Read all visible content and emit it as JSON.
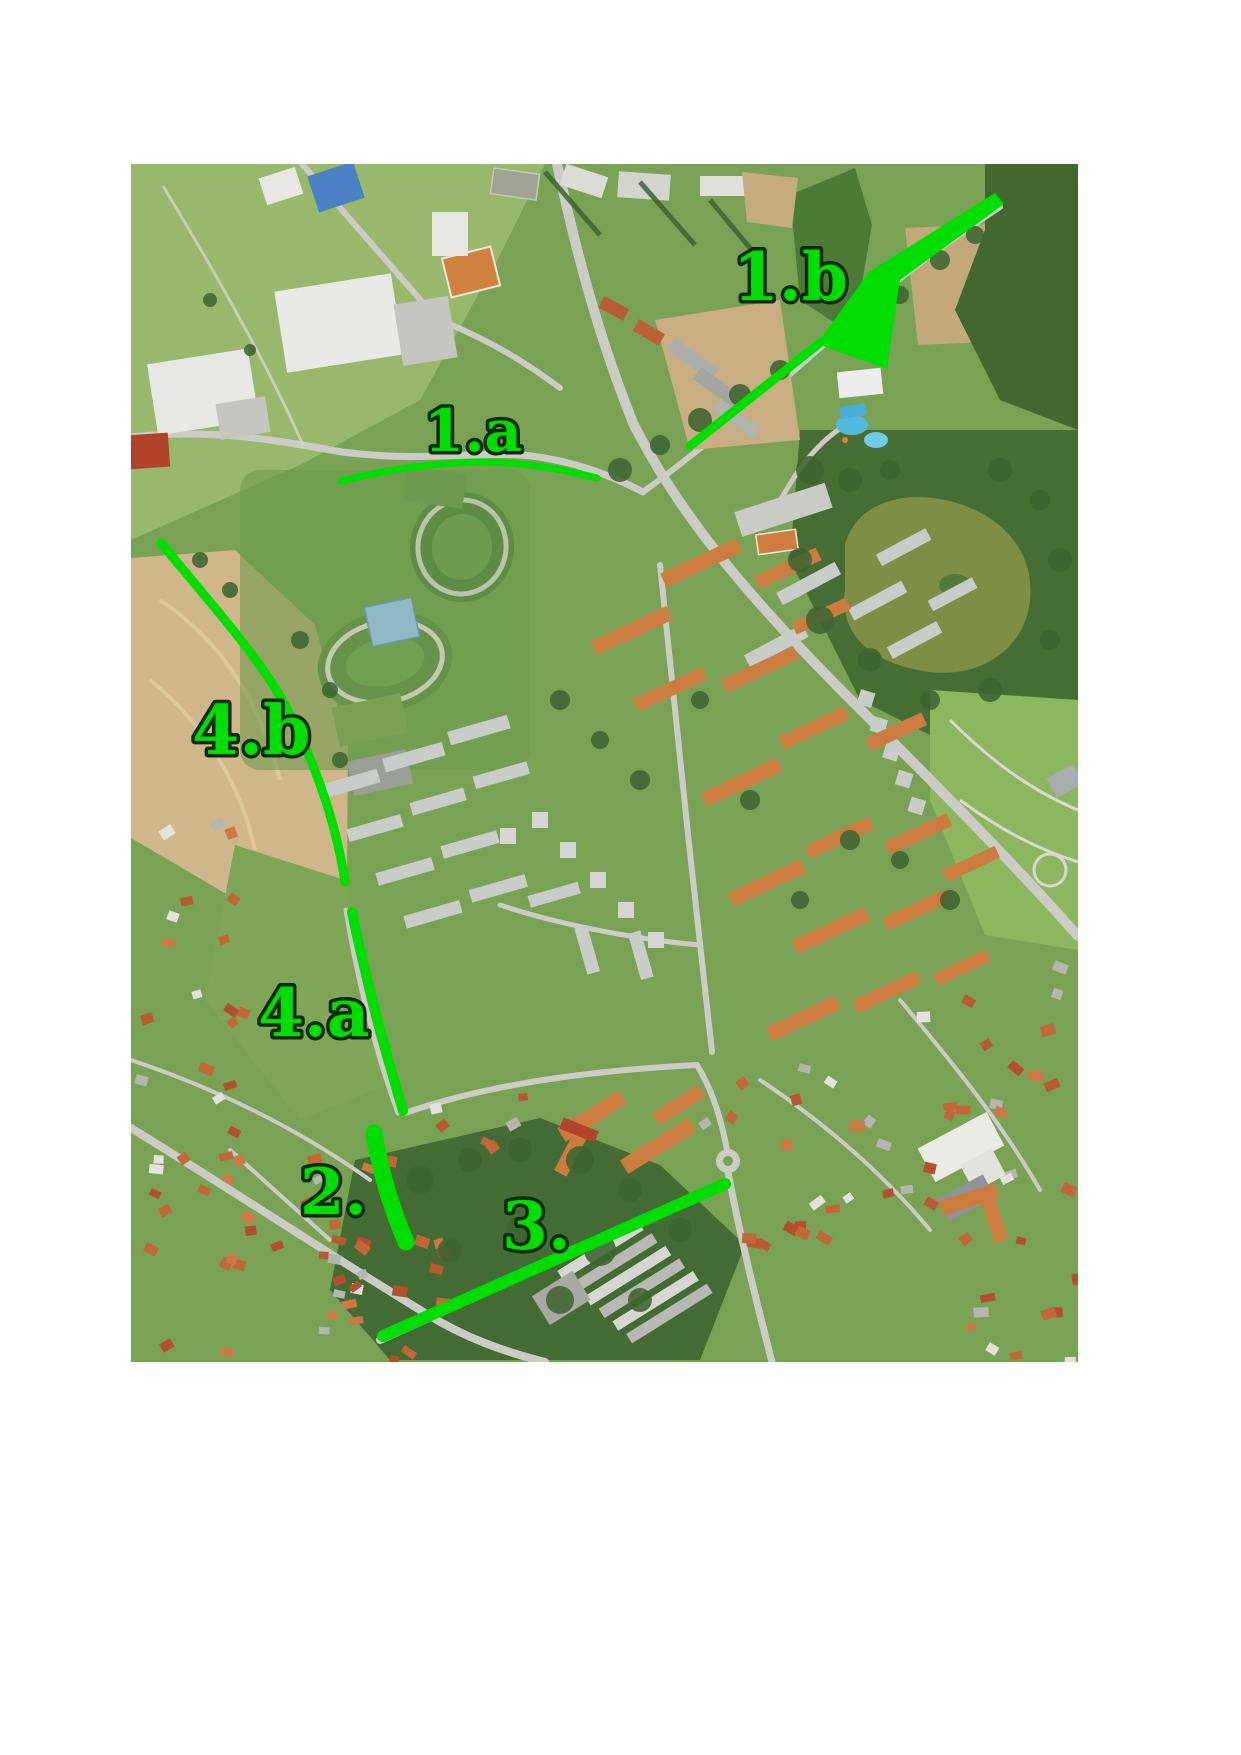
{
  "page": {
    "background_color": "#ffffff",
    "description": "Aerial orthophoto of a town with six green route annotations drawn on top"
  },
  "map": {
    "kind": "aerial-orthophoto",
    "accent_color": "#00dd00",
    "label_outline_color": "#0b2b0b",
    "photo": {
      "x": 131,
      "y": 164,
      "width": 947,
      "height": 1198
    },
    "annotations": {
      "labels": [
        {
          "id": "1a",
          "text": "1.a"
        },
        {
          "id": "1b",
          "text": "1.b"
        },
        {
          "id": "4b",
          "text": "4.b"
        },
        {
          "id": "4a",
          "text": "4.a"
        },
        {
          "id": "2",
          "text": "2."
        },
        {
          "id": "3",
          "text": "3."
        }
      ],
      "routes": [
        {
          "id": "1a",
          "label": "1.a",
          "path": "M341,481 C390,469 440,462 488,462 C530,463 570,471 597,478",
          "width": 7
        },
        {
          "id": "1b-approach",
          "label": "1.b",
          "path": "M690,446 L821,342",
          "width": 9
        },
        {
          "id": "4b",
          "label": "4.b",
          "path": "M161,543 C205,597 258,655 285,705 C310,752 335,815 345,882",
          "width": 9
        },
        {
          "id": "4a",
          "label": "4.a",
          "path": "M352,912 C362,962 382,1040 403,1111",
          "width": 10
        },
        {
          "id": "2",
          "label": "2.",
          "path": "M374,1133 C380,1170 391,1207 406,1242",
          "width": 17
        },
        {
          "id": "3",
          "label": "3.",
          "path": "M383,1336 L725,1184",
          "width": 12
        }
      ],
      "arrow": {
        "label": "1.b",
        "points": "995,193 1004,204 900,280 887,369 817,344 869,272"
      }
    }
  }
}
